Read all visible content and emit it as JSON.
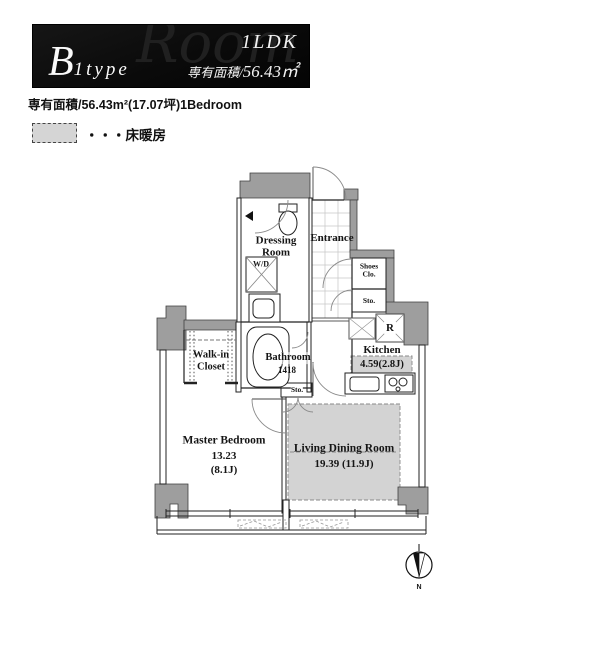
{
  "header": {
    "type_initial": "B",
    "type_rest": "1type",
    "watermark": "Room",
    "plan_type": "1LDK",
    "area_prefix": "専有面積/",
    "area_value": "56.43㎡"
  },
  "subtitle": "専有面積/56.43m²(17.07坪)1Bedroom",
  "legend": {
    "floor_heating_label": "・・・床暖房"
  },
  "rooms": {
    "entrance": "Entrance",
    "dressing_line1": "Dressing",
    "dressing_line2": "Room",
    "wd": "W/D",
    "shoes_line1": "Shoes",
    "shoes_line2": "Clo.",
    "shoes_sto": "Sto.",
    "refrigerator": "R",
    "kitchen_name": "Kitchen",
    "kitchen_size": "4.59(2.8J)",
    "bathroom_name": "Bathroom",
    "bathroom_size": "1418",
    "walkin_line1": "Walk-in",
    "walkin_line2": "Closet",
    "sto_small": "Sto.",
    "master_name": "Master Bedroom",
    "master_size": "13.23",
    "master_jo": "(8.1J)",
    "living_name": "Living Dining Room",
    "living_size": "19.39 (11.9J)"
  },
  "compass": {
    "north_label": "N"
  },
  "colors": {
    "banner_bg": "#0b0b0b",
    "wall_fill": "#9e9e9e",
    "floor_heating_fill": "#d3d3d3",
    "line_color": "#222222"
  }
}
